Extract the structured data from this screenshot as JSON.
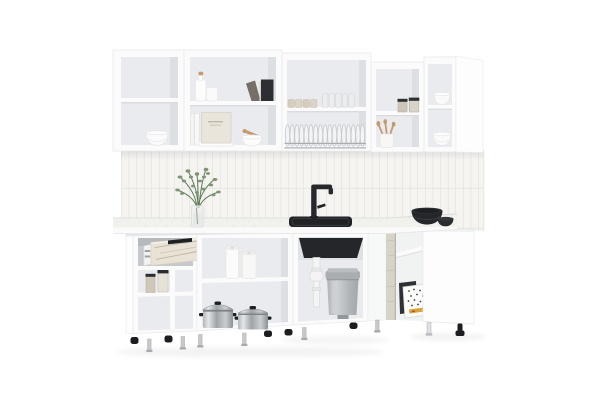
{
  "scene": {
    "type": "product-photo",
    "subject": "white-corner-kitchen-set",
    "description": "White modular L-shaped kitchen set with open wall cabinets holding bowls, a bottle, books, cups, glasses, a dish rack with plates and jars; tiled backsplash with a green plant in a glass vase; black faucet and sink; pulled-out marble-front drawer; open base cabinets with spice jars, paper rolls, two stainless pots, white sink plumbing and a grey pedal bin; textured corner post with a speckled box; adjustable legs"
  },
  "objects": [
    "wall-cabinets",
    "bowl-stack",
    "bottle-with-cork",
    "books",
    "beige-box",
    "mortar-and-pestle",
    "beige-cups",
    "glasses",
    "dish-rack-with-plates",
    "glass-jars",
    "utensil-cup",
    "corner-wall-cabinet",
    "tiled-backsplash",
    "plant-in-glass-vase",
    "black-faucet",
    "black-sink",
    "black-bowls",
    "marble-drawer",
    "spice-jars",
    "paper-rolls",
    "steel-pots",
    "p-trap-pipe",
    "pedal-bin",
    "concrete-corner-post",
    "speckled-box",
    "right-base-cabinet",
    "adjustable-legs"
  ],
  "palette": {
    "bg": "#ffffff",
    "cab": "#fbfbfc",
    "cab-bright": "#fdfdfe",
    "edge": "#e9eaec",
    "interior": "#e9ebee",
    "interior-dk": "#dde0e3",
    "tile": "#f5f4f1",
    "grout": "#dcdbd7",
    "counter-top": "#f1f1ee",
    "counter-face": "#fafafa",
    "black": "#25272b",
    "bin-grey": "#b5b8bb",
    "marble": "#e9e3d6",
    "marble-vein": "#b3ac9d",
    "wood": "#c49a6c",
    "plant": "#7d9471",
    "plant-dk": "#5f7a58",
    "glass": "#eceeef",
    "concrete": "#d7d3c9",
    "accent": "#d9a23b",
    "shadow-line": "#e0e2e4"
  }
}
